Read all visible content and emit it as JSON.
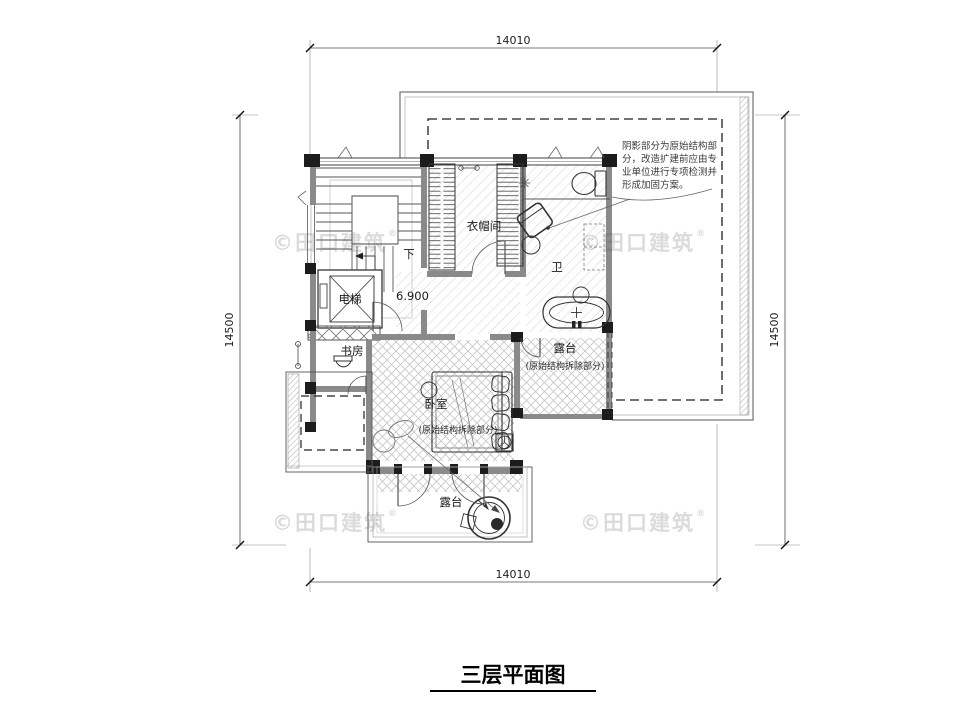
{
  "title": "三层平面图",
  "dimensions": {
    "top": "14010",
    "bottom": "14010",
    "left": "14500",
    "right": "14500"
  },
  "rooms": {
    "cloakroom": "衣帽间",
    "bathroom": "卫",
    "elevator": "电梯",
    "study": "书房",
    "bedroom": "卧室",
    "terrace_mid": "露台",
    "terrace_bottom": "露台"
  },
  "annotations": {
    "down": "下",
    "level": "6.900",
    "demolish_mid": "(原始结构拆除部分)",
    "demolish_bedroom": "(原始结构拆除部分)",
    "note_line1": "阴影部分为原始结构部",
    "note_line2": "分，改造扩建前应由专",
    "note_line3": "业单位进行专项检测并",
    "note_line4": "形成加固方案。"
  },
  "watermark": {
    "text": "©田口建筑",
    "reg": "®"
  },
  "colors": {
    "line": "#3a3a3a",
    "wall_gray": "#8a8a8a",
    "hatch": "#c9c9c9",
    "dashed": "#222222",
    "watermark": "rgba(90,90,90,0.22)"
  }
}
